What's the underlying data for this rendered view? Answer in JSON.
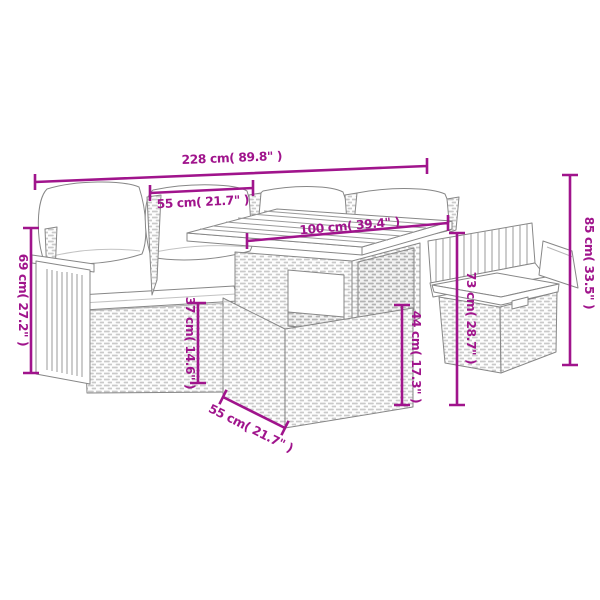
{
  "diagram": {
    "description": "Dimension diagram of a poly rattan garden lounge set: corner sofa with cushions, table with wooden slat top, footstool and bench",
    "accent_color": "#A0148C",
    "line_art_color": "#878787",
    "measurements": {
      "overall_width": {
        "text": "228 cm( 89.8\" )",
        "cm": 228,
        "inches": 89.8
      },
      "seat_section_width": {
        "text": "55 cm( 21.7\" )",
        "cm": 55,
        "inches": 21.7
      },
      "table_length": {
        "text": "100 cm( 39.4\" )",
        "cm": 100,
        "inches": 39.4
      },
      "sofa_height": {
        "text": "69 cm( 27.2\" )",
        "cm": 69,
        "inches": 27.2
      },
      "seat_base_height": {
        "text": "37 cm( 14.6\" )",
        "cm": 37,
        "inches": 14.6
      },
      "table_base_height": {
        "text": "44 cm( 17.3\" )",
        "cm": 44,
        "inches": 17.3
      },
      "table_height": {
        "text": "73 cm( 28.7\" )",
        "cm": 73,
        "inches": 28.7
      },
      "overall_height": {
        "text": "85 cm( 33.5\" )",
        "cm": 85,
        "inches": 33.5
      },
      "table_depth": {
        "text": "55 cm( 21.7\" )",
        "cm": 55,
        "inches": 21.7
      }
    }
  }
}
